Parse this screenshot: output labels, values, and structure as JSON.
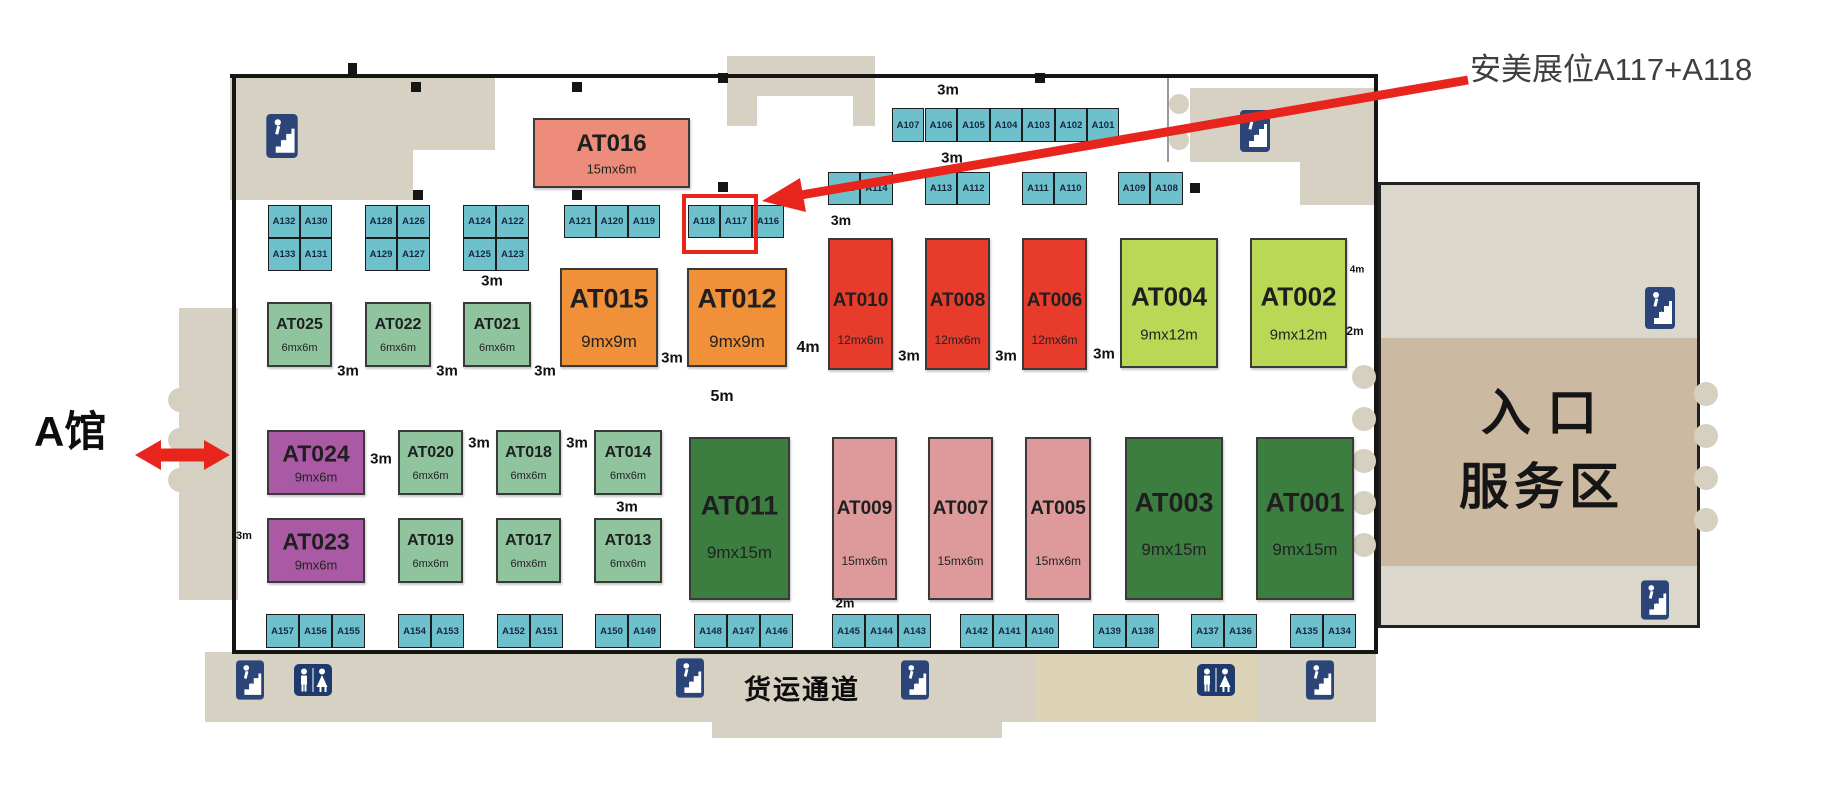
{
  "annotation": {
    "text": "安美展位A117+A118",
    "arrow_color": "#e8251d"
  },
  "site": {
    "hall_label": "A馆",
    "entrance_line1": "入口",
    "entrance_line2": "服务区",
    "freight_label": "货运通道"
  },
  "colors": {
    "cyan": "#6fc0cd",
    "salmon": "#ee8c7c",
    "orange": "#f09038",
    "red": "#e73b2b",
    "lime": "#bad755",
    "green": "#90c49f",
    "purple": "#aa5aa4",
    "dkgreen": "#3c7e40",
    "pink": "#de9a9a",
    "beige": "#d7d1c3",
    "tan": "#ccb9a1",
    "wall": "#151515",
    "highlight": "#e8251d"
  },
  "large_booths": [
    {
      "id": "AT016",
      "dim": "15mx6m",
      "c": "salmon",
      "x": 533,
      "y": 118,
      "w": 157,
      "h": 70,
      "nf": 24,
      "df": 13,
      "nt": 36,
      "dt": 74
    },
    {
      "id": "AT015",
      "dim": "9mx9m",
      "c": "orange",
      "x": 560,
      "y": 268,
      "w": 98,
      "h": 99,
      "nf": 27,
      "df": 17,
      "nt": 30,
      "dt": 76
    },
    {
      "id": "AT012",
      "dim": "9mx9m",
      "c": "orange",
      "x": 687,
      "y": 268,
      "w": 100,
      "h": 99,
      "nf": 27,
      "df": 17,
      "nt": 30,
      "dt": 76
    },
    {
      "id": "AT010",
      "dim": "12mx6m",
      "c": "red",
      "x": 828,
      "y": 238,
      "w": 65,
      "h": 132,
      "nf": 19,
      "df": 12,
      "nt": 48,
      "dt": 78
    },
    {
      "id": "AT008",
      "dim": "12mx6m",
      "c": "red",
      "x": 925,
      "y": 238,
      "w": 65,
      "h": 132,
      "nf": 19,
      "df": 12,
      "nt": 48,
      "dt": 78
    },
    {
      "id": "AT006",
      "dim": "12mx6m",
      "c": "red",
      "x": 1022,
      "y": 238,
      "w": 65,
      "h": 132,
      "nf": 19,
      "df": 12,
      "nt": 48,
      "dt": 78
    },
    {
      "id": "AT004",
      "dim": "9mx12m",
      "c": "lime",
      "x": 1120,
      "y": 238,
      "w": 98,
      "h": 130,
      "nf": 26,
      "df": 15,
      "nt": 45,
      "dt": 75
    },
    {
      "id": "AT002",
      "dim": "9mx12m",
      "c": "lime",
      "x": 1250,
      "y": 238,
      "w": 97,
      "h": 130,
      "nf": 26,
      "df": 15,
      "nt": 45,
      "dt": 75
    },
    {
      "id": "AT025",
      "dim": "6mx6m",
      "c": "green",
      "x": 267,
      "y": 302,
      "w": 65,
      "h": 65,
      "nf": 16,
      "df": 11,
      "nt": 34,
      "dt": 72
    },
    {
      "id": "AT022",
      "dim": "6mx6m",
      "c": "green",
      "x": 365,
      "y": 302,
      "w": 66,
      "h": 65,
      "nf": 16,
      "df": 11,
      "nt": 34,
      "dt": 72
    },
    {
      "id": "AT021",
      "dim": "6mx6m",
      "c": "green",
      "x": 463,
      "y": 302,
      "w": 68,
      "h": 65,
      "nf": 16,
      "df": 11,
      "nt": 34,
      "dt": 72
    },
    {
      "id": "AT024",
      "dim": "9mx6m",
      "c": "purple",
      "x": 267,
      "y": 430,
      "w": 98,
      "h": 65,
      "nf": 23,
      "df": 13,
      "nt": 36,
      "dt": 74
    },
    {
      "id": "AT020",
      "dim": "6mx6m",
      "c": "green",
      "x": 398,
      "y": 430,
      "w": 65,
      "h": 65,
      "nf": 16,
      "df": 11,
      "nt": 34,
      "dt": 72
    },
    {
      "id": "AT018",
      "dim": "6mx6m",
      "c": "green",
      "x": 496,
      "y": 430,
      "w": 65,
      "h": 65,
      "nf": 16,
      "df": 11,
      "nt": 34,
      "dt": 72
    },
    {
      "id": "AT014",
      "dim": "6mx6m",
      "c": "green",
      "x": 594,
      "y": 430,
      "w": 68,
      "h": 65,
      "nf": 16,
      "df": 11,
      "nt": 34,
      "dt": 72
    },
    {
      "id": "AT023",
      "dim": "9mx6m",
      "c": "purple",
      "x": 267,
      "y": 518,
      "w": 98,
      "h": 65,
      "nf": 23,
      "df": 13,
      "nt": 36,
      "dt": 74
    },
    {
      "id": "AT019",
      "dim": "6mx6m",
      "c": "green",
      "x": 398,
      "y": 518,
      "w": 65,
      "h": 65,
      "nf": 16,
      "df": 11,
      "nt": 34,
      "dt": 72
    },
    {
      "id": "AT017",
      "dim": "6mx6m",
      "c": "green",
      "x": 496,
      "y": 518,
      "w": 65,
      "h": 65,
      "nf": 16,
      "df": 11,
      "nt": 34,
      "dt": 72
    },
    {
      "id": "AT013",
      "dim": "6mx6m",
      "c": "green",
      "x": 594,
      "y": 518,
      "w": 68,
      "h": 65,
      "nf": 16,
      "df": 11,
      "nt": 34,
      "dt": 72
    },
    {
      "id": "AT011",
      "dim": "9mx15m",
      "c": "dkgreen",
      "x": 689,
      "y": 437,
      "w": 101,
      "h": 163,
      "nf": 27,
      "df": 17,
      "nt": 42,
      "dt": 72
    },
    {
      "id": "AT009",
      "dim": "15mx6m",
      "c": "pink",
      "x": 832,
      "y": 437,
      "w": 65,
      "h": 163,
      "nf": 19,
      "df": 12,
      "nt": 44,
      "dt": 77
    },
    {
      "id": "AT007",
      "dim": "15mx6m",
      "c": "pink",
      "x": 928,
      "y": 437,
      "w": 65,
      "h": 163,
      "nf": 19,
      "df": 12,
      "nt": 44,
      "dt": 77
    },
    {
      "id": "AT005",
      "dim": "15mx6m",
      "c": "pink",
      "x": 1025,
      "y": 437,
      "w": 66,
      "h": 163,
      "nf": 19,
      "df": 12,
      "nt": 44,
      "dt": 77
    },
    {
      "id": "AT003",
      "dim": "9mx15m",
      "c": "dkgreen",
      "x": 1125,
      "y": 437,
      "w": 98,
      "h": 163,
      "nf": 27,
      "df": 17,
      "nt": 40,
      "dt": 70
    },
    {
      "id": "AT001",
      "dim": "9mx15m",
      "c": "dkgreen",
      "x": 1256,
      "y": 437,
      "w": 98,
      "h": 163,
      "nf": 27,
      "df": 17,
      "nt": 40,
      "dt": 70
    }
  ],
  "small_booths": [
    {
      "id": "A107",
      "x": 892,
      "y": 108,
      "w": 32,
      "h": 34
    },
    {
      "id": "A106",
      "x": 925,
      "y": 108,
      "w": 32,
      "h": 34
    },
    {
      "id": "A105",
      "x": 957,
      "y": 108,
      "w": 33,
      "h": 34
    },
    {
      "id": "A104",
      "x": 990,
      "y": 108,
      "w": 32,
      "h": 34
    },
    {
      "id": "A103",
      "x": 1022,
      "y": 108,
      "w": 33,
      "h": 34
    },
    {
      "id": "A102",
      "x": 1055,
      "y": 108,
      "w": 32,
      "h": 34
    },
    {
      "id": "A101",
      "x": 1087,
      "y": 108,
      "w": 32,
      "h": 34
    },
    {
      "id": "A115",
      "x": 828,
      "y": 172,
      "w": 32,
      "h": 33
    },
    {
      "id": "A114",
      "x": 860,
      "y": 172,
      "w": 33,
      "h": 33
    },
    {
      "id": "A113",
      "x": 925,
      "y": 172,
      "w": 32,
      "h": 33
    },
    {
      "id": "A112",
      "x": 957,
      "y": 172,
      "w": 33,
      "h": 33
    },
    {
      "id": "A111",
      "x": 1022,
      "y": 172,
      "w": 32,
      "h": 33
    },
    {
      "id": "A110",
      "x": 1054,
      "y": 172,
      "w": 33,
      "h": 33
    },
    {
      "id": "A109",
      "x": 1118,
      "y": 172,
      "w": 32,
      "h": 33
    },
    {
      "id": "A108",
      "x": 1150,
      "y": 172,
      "w": 33,
      "h": 33
    },
    {
      "id": "A132",
      "x": 268,
      "y": 205,
      "w": 32,
      "h": 33
    },
    {
      "id": "A130",
      "x": 300,
      "y": 205,
      "w": 32,
      "h": 33
    },
    {
      "id": "A133",
      "x": 268,
      "y": 238,
      "w": 32,
      "h": 33
    },
    {
      "id": "A131",
      "x": 300,
      "y": 238,
      "w": 32,
      "h": 33
    },
    {
      "id": "A128",
      "x": 365,
      "y": 205,
      "w": 32,
      "h": 33
    },
    {
      "id": "A126",
      "x": 397,
      "y": 205,
      "w": 33,
      "h": 33
    },
    {
      "id": "A129",
      "x": 365,
      "y": 238,
      "w": 32,
      "h": 33
    },
    {
      "id": "A127",
      "x": 397,
      "y": 238,
      "w": 33,
      "h": 33
    },
    {
      "id": "A124",
      "x": 463,
      "y": 205,
      "w": 33,
      "h": 33
    },
    {
      "id": "A122",
      "x": 496,
      "y": 205,
      "w": 33,
      "h": 33
    },
    {
      "id": "A125",
      "x": 463,
      "y": 238,
      "w": 33,
      "h": 33
    },
    {
      "id": "A123",
      "x": 496,
      "y": 238,
      "w": 33,
      "h": 33
    },
    {
      "id": "A121",
      "x": 564,
      "y": 205,
      "w": 32,
      "h": 33
    },
    {
      "id": "A120",
      "x": 596,
      "y": 205,
      "w": 32,
      "h": 33
    },
    {
      "id": "A119",
      "x": 628,
      "y": 205,
      "w": 32,
      "h": 33
    },
    {
      "id": "A118",
      "x": 688,
      "y": 205,
      "w": 32,
      "h": 33
    },
    {
      "id": "A117",
      "x": 720,
      "y": 205,
      "w": 32,
      "h": 33
    },
    {
      "id": "A116",
      "x": 752,
      "y": 205,
      "w": 32,
      "h": 33
    },
    {
      "id": "A157",
      "x": 266,
      "y": 614,
      "w": 33,
      "h": 34
    },
    {
      "id": "A156",
      "x": 299,
      "y": 614,
      "w": 33,
      "h": 34
    },
    {
      "id": "A155",
      "x": 332,
      "y": 614,
      "w": 33,
      "h": 34
    },
    {
      "id": "A154",
      "x": 398,
      "y": 614,
      "w": 33,
      "h": 34
    },
    {
      "id": "A153",
      "x": 431,
      "y": 614,
      "w": 33,
      "h": 34
    },
    {
      "id": "A152",
      "x": 497,
      "y": 614,
      "w": 33,
      "h": 34
    },
    {
      "id": "A151",
      "x": 530,
      "y": 614,
      "w": 33,
      "h": 34
    },
    {
      "id": "A150",
      "x": 595,
      "y": 614,
      "w": 33,
      "h": 34
    },
    {
      "id": "A149",
      "x": 628,
      "y": 614,
      "w": 33,
      "h": 34
    },
    {
      "id": "A148",
      "x": 694,
      "y": 614,
      "w": 33,
      "h": 34
    },
    {
      "id": "A147",
      "x": 727,
      "y": 614,
      "w": 33,
      "h": 34
    },
    {
      "id": "A146",
      "x": 760,
      "y": 614,
      "w": 33,
      "h": 34
    },
    {
      "id": "A145",
      "x": 832,
      "y": 614,
      "w": 33,
      "h": 34
    },
    {
      "id": "A144",
      "x": 865,
      "y": 614,
      "w": 33,
      "h": 34
    },
    {
      "id": "A143",
      "x": 898,
      "y": 614,
      "w": 33,
      "h": 34
    },
    {
      "id": "A142",
      "x": 960,
      "y": 614,
      "w": 33,
      "h": 34
    },
    {
      "id": "A141",
      "x": 993,
      "y": 614,
      "w": 33,
      "h": 34
    },
    {
      "id": "A140",
      "x": 1026,
      "y": 614,
      "w": 33,
      "h": 34
    },
    {
      "id": "A139",
      "x": 1093,
      "y": 614,
      "w": 33,
      "h": 34
    },
    {
      "id": "A138",
      "x": 1126,
      "y": 614,
      "w": 33,
      "h": 34
    },
    {
      "id": "A137",
      "x": 1191,
      "y": 614,
      "w": 33,
      "h": 34
    },
    {
      "id": "A136",
      "x": 1224,
      "y": 614,
      "w": 33,
      "h": 34
    },
    {
      "id": "A135",
      "x": 1290,
      "y": 614,
      "w": 33,
      "h": 34
    },
    {
      "id": "A134",
      "x": 1323,
      "y": 614,
      "w": 33,
      "h": 34
    }
  ],
  "dim_labels": [
    {
      "t": "3m",
      "x": 948,
      "y": 90,
      "fs": 15
    },
    {
      "t": "3m",
      "x": 952,
      "y": 158,
      "fs": 15
    },
    {
      "t": "3m",
      "x": 841,
      "y": 220,
      "fs": 14
    },
    {
      "t": "3m",
      "x": 492,
      "y": 281,
      "fs": 15
    },
    {
      "t": "3m",
      "x": 348,
      "y": 371,
      "fs": 15
    },
    {
      "t": "3m",
      "x": 447,
      "y": 371,
      "fs": 15
    },
    {
      "t": "3m",
      "x": 545,
      "y": 371,
      "fs": 15
    },
    {
      "t": "3m",
      "x": 672,
      "y": 358,
      "fs": 15
    },
    {
      "t": "4m",
      "x": 808,
      "y": 348,
      "fs": 16
    },
    {
      "t": "3m",
      "x": 909,
      "y": 356,
      "fs": 15
    },
    {
      "t": "3m",
      "x": 1006,
      "y": 356,
      "fs": 15
    },
    {
      "t": "3m",
      "x": 1104,
      "y": 354,
      "fs": 15
    },
    {
      "t": "4m",
      "x": 1357,
      "y": 270,
      "fs": 10
    },
    {
      "t": "2m",
      "x": 1355,
      "y": 331,
      "fs": 12
    },
    {
      "t": "5m",
      "x": 722,
      "y": 397,
      "fs": 16
    },
    {
      "t": "3m",
      "x": 381,
      "y": 459,
      "fs": 15
    },
    {
      "t": "3m",
      "x": 479,
      "y": 443,
      "fs": 15
    },
    {
      "t": "3m",
      "x": 577,
      "y": 443,
      "fs": 15
    },
    {
      "t": "3m",
      "x": 627,
      "y": 507,
      "fs": 15
    },
    {
      "t": "3m",
      "x": 244,
      "y": 536,
      "fs": 11
    },
    {
      "t": "2m",
      "x": 845,
      "y": 603,
      "fs": 13
    }
  ],
  "icons": [
    {
      "k": "stairs",
      "x": 266,
      "y": 114,
      "w": 32,
      "h": 44
    },
    {
      "k": "stairs",
      "x": 1240,
      "y": 110,
      "w": 30,
      "h": 42
    },
    {
      "k": "stairs",
      "x": 1645,
      "y": 287,
      "w": 30,
      "h": 42
    },
    {
      "k": "stairs",
      "x": 1641,
      "y": 580,
      "w": 28,
      "h": 40
    },
    {
      "k": "stairs",
      "x": 236,
      "y": 660,
      "w": 28,
      "h": 40
    },
    {
      "k": "stairs",
      "x": 676,
      "y": 658,
      "w": 28,
      "h": 40
    },
    {
      "k": "stairs",
      "x": 901,
      "y": 660,
      "w": 28,
      "h": 40
    },
    {
      "k": "stairs",
      "x": 1306,
      "y": 660,
      "w": 28,
      "h": 40
    },
    {
      "k": "toilet",
      "x": 294,
      "y": 664,
      "w": 38,
      "h": 32
    },
    {
      "k": "toilet",
      "x": 1197,
      "y": 664,
      "w": 38,
      "h": 32
    }
  ]
}
